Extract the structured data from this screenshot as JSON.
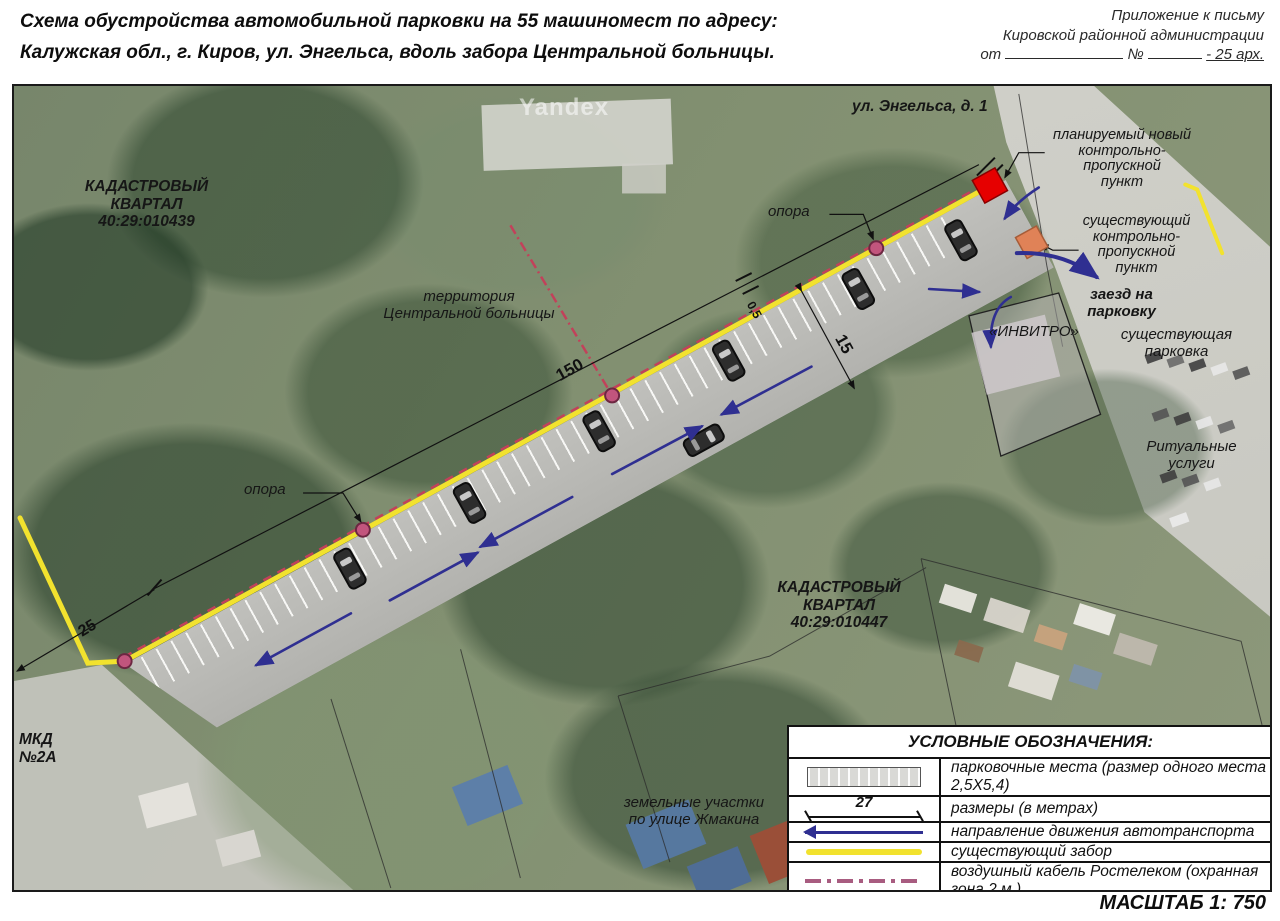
{
  "header": {
    "title": "Схема обустройства автомобильной парковки на 55 машиномест по адресу:\nКалужская обл., г. Киров, ул. Энгельса, вдоль забора Центральной больницы.",
    "annotation_line1": "Приложение к письму",
    "annotation_line2": "Кировской районной администрации",
    "annotation_from": "от",
    "annotation_no": "№",
    "annotation_tail": "- 25 арх."
  },
  "map": {
    "watermark": "Yandex",
    "labels": {
      "street": "ул. Энгельса, д. 1",
      "kpp_new": "планируемый новый\nконтрольно-\nпропускной\nпункт",
      "kpp_existing": "существующий\nконтрольно-\nпропускной\nпункт",
      "entry": "заезд на\nпарковку",
      "invitro": "«ИНВИТРО»",
      "existing_parking": "существующая\nпарковка",
      "ritual": "Ритуальные\nуслуги",
      "cadastral_1": "КАДАСТРОВЫЙ\nКВАРТАЛ\n40:29:010439",
      "cadastral_2": "КАДАСТРОВЫЙ\nКВАРТАЛ\n40:29:010447",
      "hospital": "территория\nЦентральной больницы",
      "opora_left": "опора",
      "opora_top": "опора",
      "mkd": "МКД\n№2А",
      "zhmakina": "земельные участки\nпо улице Жмакина"
    },
    "dimensions": {
      "d150": "150",
      "d15": "15",
      "d05": "0,5",
      "d25": "25"
    }
  },
  "legend": {
    "title": "УСЛОВНЫЕ ОБОЗНАЧЕНИЯ:",
    "rows": [
      {
        "symbol": "parking-swatch",
        "text": "парковочные места (размер одного места 2,5Х5,4)"
      },
      {
        "symbol": "dimension",
        "value": "27",
        "text": "размеры (в метрах)"
      },
      {
        "symbol": "direction-arrow",
        "text": "направление движения автотранспорта"
      },
      {
        "symbol": "fence-line",
        "text": "существующий забор"
      },
      {
        "symbol": "cable-line",
        "text": "воздушный кабель Ростелеком (охранная зона 2 м.)"
      }
    ],
    "scale": "МАСШТАБ 1: 750"
  },
  "colors": {
    "fence": "#f2e22e",
    "cable": "#c2415a",
    "traffic_arrow": "#2f2f91",
    "kpp_new": "#e60000",
    "kpp_existing": "#e08257",
    "pole": "#c2557d"
  }
}
